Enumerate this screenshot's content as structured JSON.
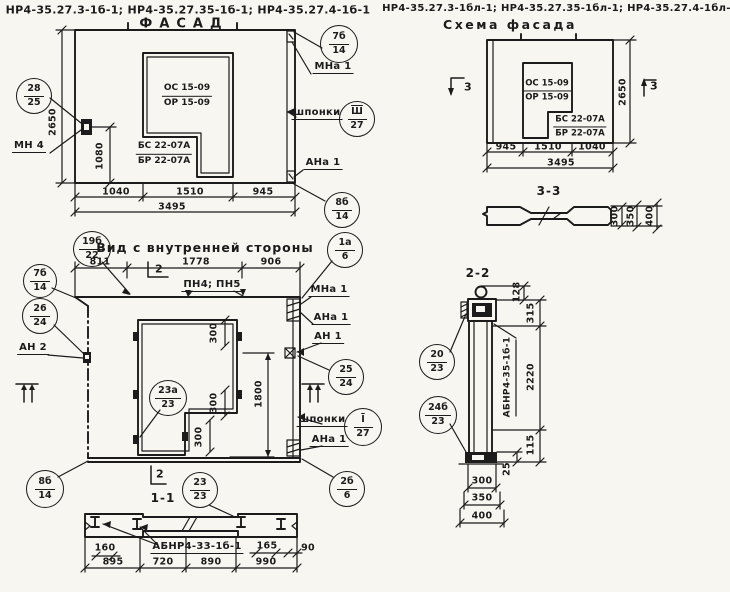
{
  "page": {
    "background": "#f7f6f1",
    "ink": "#1b1b1b"
  },
  "titles": {
    "left_codes": "НР4-35.27.3-1б-1; НР4-35.27.35-1б-1; НР4-35.27.4-1б-1",
    "facade": "ФАСАД",
    "right_codes": "НР4-35.27.3-1бл-1; НР4-35.27.35-1бл-1; НР4-35.27.4-1бл-1",
    "schema": "Схема фасада",
    "inner_view": "Вид с внутренней стороны",
    "section_1_1": "1-1",
    "section_2_2": "2-2",
    "section_3_3": "3-3"
  },
  "marks": {
    "s2_top": "2",
    "s2_bottom": "2",
    "s3_left": "3",
    "s3_right": "3"
  },
  "callouts": [
    {
      "top": "28",
      "bottom": "25"
    },
    {
      "top": "7б",
      "bottom": "14"
    },
    {
      "top": "Ш",
      "bottom": "27"
    },
    {
      "top": "8б",
      "bottom": "14"
    },
    {
      "top": "19б",
      "bottom": "22"
    },
    {
      "top": "7б",
      "bottom": "14"
    },
    {
      "top": "26",
      "bottom": "24"
    },
    {
      "top": "8б",
      "bottom": "14"
    },
    {
      "top": "23а",
      "bottom": "23"
    },
    {
      "top": "1а",
      "bottom": "6"
    },
    {
      "top": "25",
      "bottom": "24"
    },
    {
      "top": "I",
      "bottom": "27"
    },
    {
      "top": "2б",
      "bottom": "6"
    },
    {
      "top": "23",
      "bottom": "23"
    },
    {
      "top": "20",
      "bottom": "23"
    },
    {
      "top": "24б",
      "bottom": "23"
    }
  ],
  "labels": {
    "mn4": "МН 4",
    "mna1_f": "МНа 1",
    "shponki_f": "шпонки",
    "ana1_f": "АНа 1",
    "pn45": "ПН4; ПН5",
    "an2": "АН 2",
    "mna1_i": "МНа 1",
    "ana1_i": "АНа 1",
    "an1": "АН 1",
    "shponki_i": "шпонки",
    "ana1_i2": "АНа 1",
    "ab_11": "АБНР4-33-1б-1",
    "ab_22": "АБНР4-35-1б-1"
  },
  "stamps": {
    "f1a": "ОС 15-09",
    "f1b": "ОР 15-09",
    "f2a": "БС 22-07А",
    "f2b": "БР 22-07А",
    "s1a": "ОС 15-09",
    "s1b": "ОР 15-09",
    "s2a": "БС 22-07А",
    "s2b": "БР 22-07А"
  },
  "dims": {
    "facade": {
      "h": "2650",
      "h2": "1080",
      "a": "1040",
      "b": "1510",
      "c": "945",
      "total": "3495"
    },
    "inner": {
      "a": "811",
      "b": "1778",
      "c": "906",
      "t1": "300",
      "t2": "300",
      "t3": "300",
      "h": "1800"
    },
    "s11": {
      "a": "160",
      "b": "165",
      "c": "90",
      "w1": "895",
      "w2": "720",
      "w3": "890",
      "w4": "990"
    },
    "schema": {
      "a": "945",
      "b": "1510",
      "c": "1040",
      "total": "3495",
      "h": "2650"
    },
    "s33": {
      "a": "300",
      "b": "350",
      "c": "400"
    },
    "s22": {
      "a": "128",
      "b": "315",
      "c": "2220",
      "d": "115",
      "e": "25",
      "w1": "300",
      "w2": "350",
      "w3": "400"
    }
  }
}
